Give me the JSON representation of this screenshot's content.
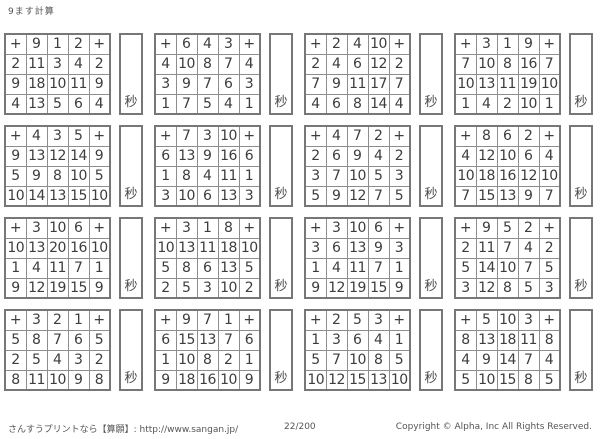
{
  "page": {
    "title": "9ます計算",
    "footer": {
      "left": "さんすうプリントなら【算願】: http://www.sangan.jp/",
      "center": "22/200",
      "right": "Copyright © Alpha, Inc All Rights Reserved."
    }
  },
  "symbols": {
    "plus": "+",
    "seconds": "秒"
  },
  "colors": {
    "answer_red": "#cb4f4b",
    "text_dark": "#3d3d3d",
    "border_gray": "#8d8d8d"
  },
  "grids": [
    {
      "top": [
        9,
        1,
        2
      ],
      "rows": [
        {
          "left": 2,
          "answers": [
            11,
            3,
            4
          ]
        },
        {
          "left": 9,
          "answers": [
            18,
            10,
            11
          ]
        },
        {
          "left": 4,
          "answers": [
            13,
            5,
            6
          ]
        }
      ]
    },
    {
      "top": [
        6,
        4,
        3
      ],
      "rows": [
        {
          "left": 4,
          "answers": [
            10,
            8,
            7
          ]
        },
        {
          "left": 3,
          "answers": [
            9,
            7,
            6
          ]
        },
        {
          "left": 1,
          "answers": [
            7,
            5,
            4
          ]
        }
      ]
    },
    {
      "top": [
        2,
        4,
        10
      ],
      "rows": [
        {
          "left": 2,
          "answers": [
            4,
            6,
            12
          ]
        },
        {
          "left": 7,
          "answers": [
            9,
            11,
            17
          ]
        },
        {
          "left": 4,
          "answers": [
            6,
            8,
            14
          ]
        }
      ]
    },
    {
      "top": [
        3,
        1,
        9
      ],
      "rows": [
        {
          "left": 7,
          "answers": [
            10,
            8,
            16
          ]
        },
        {
          "left": 10,
          "answers": [
            13,
            11,
            19
          ]
        },
        {
          "left": 1,
          "answers": [
            4,
            2,
            10
          ]
        }
      ]
    },
    {
      "top": [
        4,
        3,
        5
      ],
      "rows": [
        {
          "left": 9,
          "answers": [
            13,
            12,
            14
          ]
        },
        {
          "left": 5,
          "answers": [
            9,
            8,
            10
          ]
        },
        {
          "left": 10,
          "answers": [
            14,
            13,
            15
          ]
        }
      ]
    },
    {
      "top": [
        7,
        3,
        10
      ],
      "rows": [
        {
          "left": 6,
          "answers": [
            13,
            9,
            16
          ]
        },
        {
          "left": 1,
          "answers": [
            8,
            4,
            11
          ]
        },
        {
          "left": 3,
          "answers": [
            10,
            6,
            13
          ]
        }
      ]
    },
    {
      "top": [
        4,
        7,
        2
      ],
      "rows": [
        {
          "left": 2,
          "answers": [
            6,
            9,
            4
          ]
        },
        {
          "left": 3,
          "answers": [
            7,
            10,
            5
          ]
        },
        {
          "left": 5,
          "answers": [
            9,
            12,
            7
          ]
        }
      ]
    },
    {
      "top": [
        8,
        6,
        2
      ],
      "rows": [
        {
          "left": 4,
          "answers": [
            12,
            10,
            6
          ]
        },
        {
          "left": 10,
          "answers": [
            18,
            16,
            12
          ]
        },
        {
          "left": 7,
          "answers": [
            15,
            13,
            9
          ]
        }
      ]
    },
    {
      "top": [
        3,
        10,
        6
      ],
      "rows": [
        {
          "left": 10,
          "answers": [
            13,
            20,
            16
          ]
        },
        {
          "left": 1,
          "answers": [
            4,
            11,
            7
          ]
        },
        {
          "left": 9,
          "answers": [
            12,
            19,
            15
          ]
        }
      ]
    },
    {
      "top": [
        3,
        1,
        8
      ],
      "rows": [
        {
          "left": 10,
          "answers": [
            13,
            11,
            18
          ]
        },
        {
          "left": 5,
          "answers": [
            8,
            6,
            13
          ]
        },
        {
          "left": 2,
          "answers": [
            5,
            3,
            10
          ]
        }
      ]
    },
    {
      "top": [
        3,
        10,
        6
      ],
      "rows": [
        {
          "left": 3,
          "answers": [
            6,
            13,
            9
          ]
        },
        {
          "left": 1,
          "answers": [
            4,
            11,
            7
          ]
        },
        {
          "left": 9,
          "answers": [
            12,
            19,
            15
          ]
        }
      ]
    },
    {
      "top": [
        9,
        5,
        2
      ],
      "rows": [
        {
          "left": 2,
          "answers": [
            11,
            7,
            4
          ]
        },
        {
          "left": 5,
          "answers": [
            14,
            10,
            7
          ]
        },
        {
          "left": 3,
          "answers": [
            12,
            8,
            5
          ]
        }
      ]
    },
    {
      "top": [
        3,
        2,
        1
      ],
      "rows": [
        {
          "left": 5,
          "answers": [
            8,
            7,
            6
          ]
        },
        {
          "left": 2,
          "answers": [
            5,
            4,
            3
          ]
        },
        {
          "left": 8,
          "answers": [
            11,
            10,
            9
          ]
        }
      ]
    },
    {
      "top": [
        9,
        7,
        1
      ],
      "rows": [
        {
          "left": 6,
          "answers": [
            15,
            13,
            7
          ]
        },
        {
          "left": 1,
          "answers": [
            10,
            8,
            2
          ]
        },
        {
          "left": 9,
          "answers": [
            18,
            16,
            10
          ]
        }
      ]
    },
    {
      "top": [
        2,
        5,
        3
      ],
      "rows": [
        {
          "left": 1,
          "answers": [
            3,
            6,
            4
          ]
        },
        {
          "left": 5,
          "answers": [
            7,
            10,
            8
          ]
        },
        {
          "left": 10,
          "answers": [
            12,
            15,
            13
          ]
        }
      ]
    },
    {
      "top": [
        5,
        10,
        3
      ],
      "rows": [
        {
          "left": 8,
          "answers": [
            13,
            18,
            11
          ]
        },
        {
          "left": 4,
          "answers": [
            9,
            14,
            7
          ]
        },
        {
          "left": 5,
          "answers": [
            10,
            15,
            8
          ]
        }
      ]
    }
  ]
}
